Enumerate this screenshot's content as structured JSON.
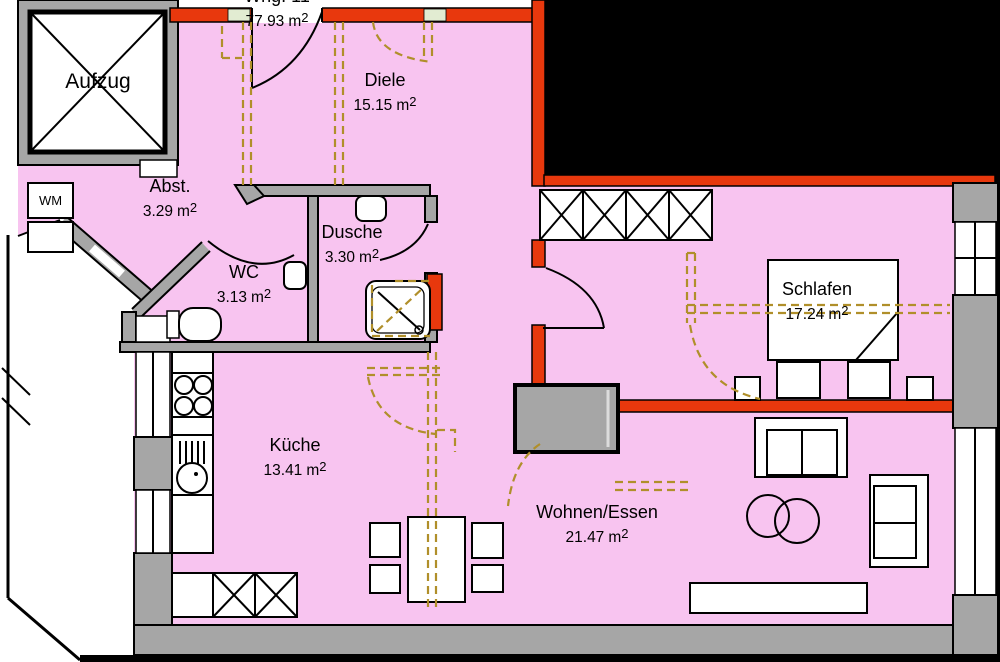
{
  "rooms": {
    "whg": {
      "name": "Whg. 11",
      "area": "77.93"
    },
    "diele": {
      "name": "Diele",
      "area": "15.15"
    },
    "abst": {
      "name": "Abst.",
      "area": "3.29"
    },
    "wc": {
      "name": "WC",
      "area": "3.13"
    },
    "dusche": {
      "name": "Dusche",
      "area": "3.30"
    },
    "kueche": {
      "name": "Küche",
      "area": "13.41"
    },
    "wohnen": {
      "name": "Wohnen/Essen",
      "area": "21.47"
    },
    "schlafen": {
      "name": "Schlafen",
      "area": "17.24"
    }
  },
  "labels": {
    "elevator": "Aufzug",
    "washing_machine": "WM"
  },
  "units": {
    "m": "m",
    "exp": "2"
  },
  "colors": {
    "interior_fill": "#f8c4f0",
    "new_wall_red": "#e8380d",
    "demolition_dash": "#b08f2a",
    "wall_gray": "#a6a6a6",
    "outline": "#000000"
  }
}
